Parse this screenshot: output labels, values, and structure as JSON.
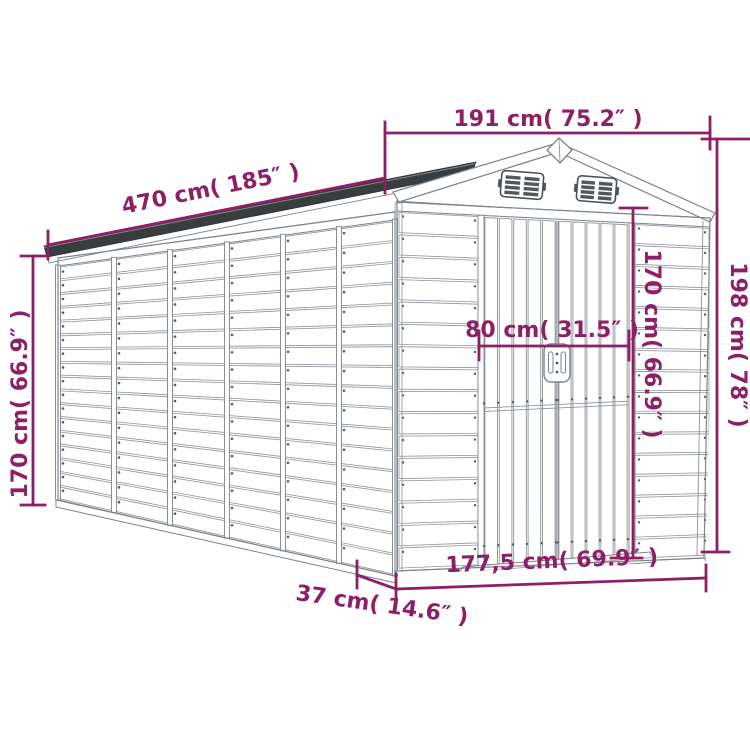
{
  "page": {
    "background": "#ffffff",
    "title": "Garden shed dimension diagram"
  },
  "style": {
    "dimension_color": "#8d1f66",
    "outline_color": "#7d838a",
    "roof_color": "#3a3d3f"
  },
  "dimensions": {
    "roof_width_front": {
      "label": "191 cm( 75.2″ )"
    },
    "roof_length_side": {
      "label": "470 cm( 185″ )"
    },
    "total_height_right": {
      "label": "198 cm( 78″ )"
    },
    "wall_height_left": {
      "label": "170 cm( 66.9″ )"
    },
    "door_height": {
      "label": "170 cm( 66.9″ )"
    },
    "door_width": {
      "label": "80 cm( 31.5″ )"
    },
    "base_width_front": {
      "label": "177,5 cm( 69.9″ )"
    },
    "base_depth_offset": {
      "label": "37 cm( 14.6″ )"
    }
  }
}
